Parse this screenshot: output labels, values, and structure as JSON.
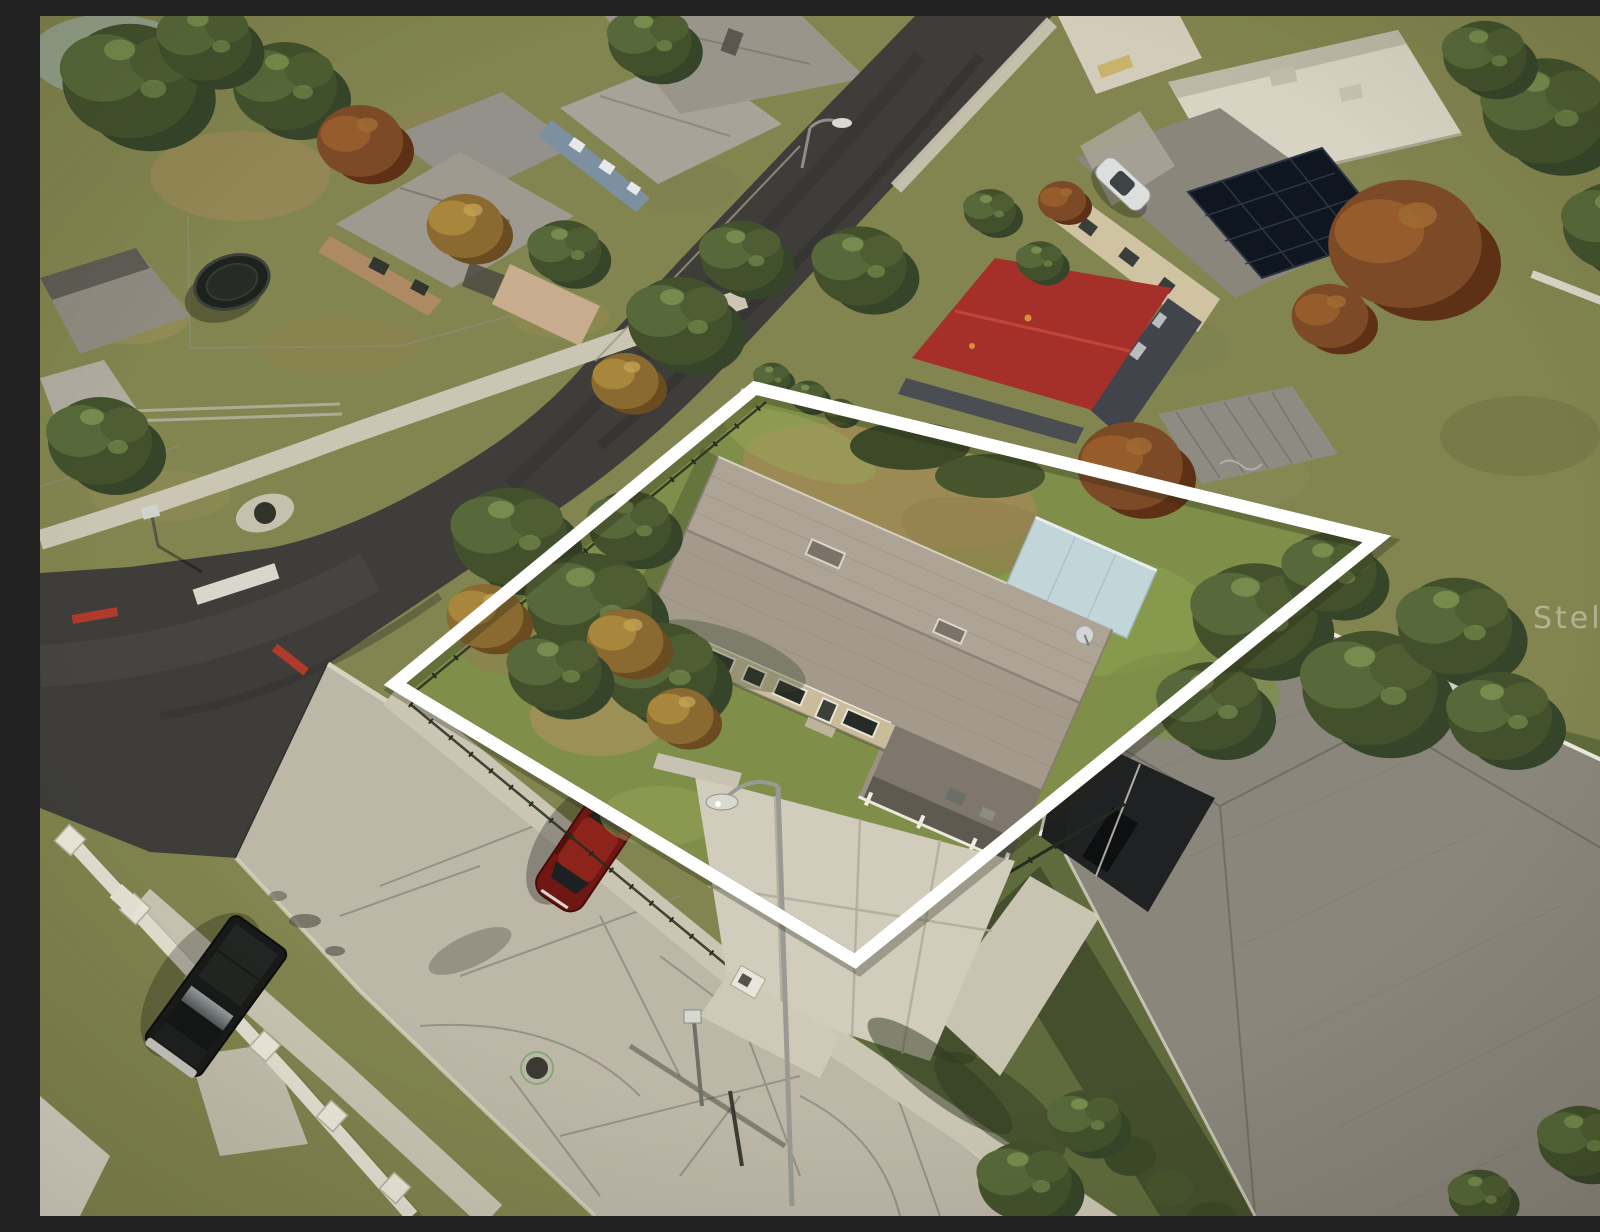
{
  "meta": {
    "title": "Aerial drone photo of corner-lot property with white boundary outline",
    "type": "real-estate-drone-photo"
  },
  "watermark": {
    "text": "Stellar"
  },
  "palette": {
    "asphalt": "#3e3d3a",
    "asphaltWorn": "#55534d",
    "concreteRoad": "#bdb7a8",
    "concreteCrack": "#8e887a",
    "sidewalk": "#cbc5b4",
    "curb": "#d8d2c1",
    "grassBase": "#82854f",
    "grassDry": "#9b8a58",
    "lotLawn": "#7f8e49",
    "lawnBrown": "#a08a55",
    "treeDark": "#3f4d2a",
    "treeMid": "#57693a",
    "treeLight": "#7e9452",
    "treeAutumn": "#8a6a30",
    "treeRust": "#7c4a26",
    "boundary": "#ffffff",
    "fenceDark": "#252a1e",
    "privacyFence": "#c7c2b4",
    "subjectRoof": "#a39a8c",
    "subjectWall": "#cabc9b",
    "annexBlue": "#c2d6da",
    "neighborRoof": "#8b867b",
    "redRoof": "#a5302a",
    "solarPanel": "#10161f",
    "beigeRoof": "#d9d3c3",
    "redCar": "#701713",
    "truckBlack": "#181a19",
    "whiteWall": "#e6e1d2",
    "tealBin": "#2ba7b5",
    "redCurb": "#b03a2c",
    "stopLine": "#d9d7cc"
  },
  "scene": {
    "objects": [
      {
        "name": "property-boundary",
        "description": "White outline overlay marking the corner lot"
      },
      {
        "name": "subject-house",
        "description": "Single-story house, gray shingle roof, beige walls, attached carport"
      },
      {
        "name": "annex-flat-roof",
        "description": "Light blue flat-roof addition on rear of subject house"
      },
      {
        "name": "satellite-dish",
        "description": "Small dish on east roof end"
      },
      {
        "name": "driveway",
        "description": "Wide concrete driveway to the street"
      },
      {
        "name": "street-lamp",
        "description": "Cobra-head street light in front yard"
      },
      {
        "name": "mailbox",
        "description": "White mailbox at the curb"
      },
      {
        "name": "asphalt-road",
        "description": "Dark repaved street curving around the west corner"
      },
      {
        "name": "concrete-road",
        "description": "Old cracked concrete street along the south side"
      },
      {
        "name": "stop-line",
        "description": "White stop bar painted at the intersection"
      },
      {
        "name": "red-curb",
        "description": "Red painted curb sections at the curve"
      },
      {
        "name": "pickup-truck",
        "description": "Black pickup parked on the street, lower left"
      },
      {
        "name": "red-car",
        "description": "Dark red car parked along the curb"
      },
      {
        "name": "white-car",
        "description": "White car parked near the top street"
      },
      {
        "name": "red-roof-house",
        "description": "Neighbor building with bright red metal roof behind the lot"
      },
      {
        "name": "solar-panel-house",
        "description": "Neighbor house with rooftop solar array, top right"
      },
      {
        "name": "metal-shed",
        "description": "Small corrugated-roof shed behind the back fence"
      },
      {
        "name": "privacy-fence",
        "description": "Light gray privacy fence along the rear lot line"
      },
      {
        "name": "black-fence",
        "description": "Black metal fence inside the west and south boundary"
      },
      {
        "name": "neighbor-house-right",
        "description": "Large gray hip-roof house with carport, right side"
      },
      {
        "name": "recycling-bin",
        "description": "Teal bin near the shared lot line"
      },
      {
        "name": "trampoline",
        "description": "Trampoline with black net in upper-left backyard"
      },
      {
        "name": "white-wall",
        "description": "Low white masonry wall with pillars, lower left"
      },
      {
        "name": "storm-drain",
        "description": "Drain and manhole covers near the intersection"
      }
    ]
  }
}
